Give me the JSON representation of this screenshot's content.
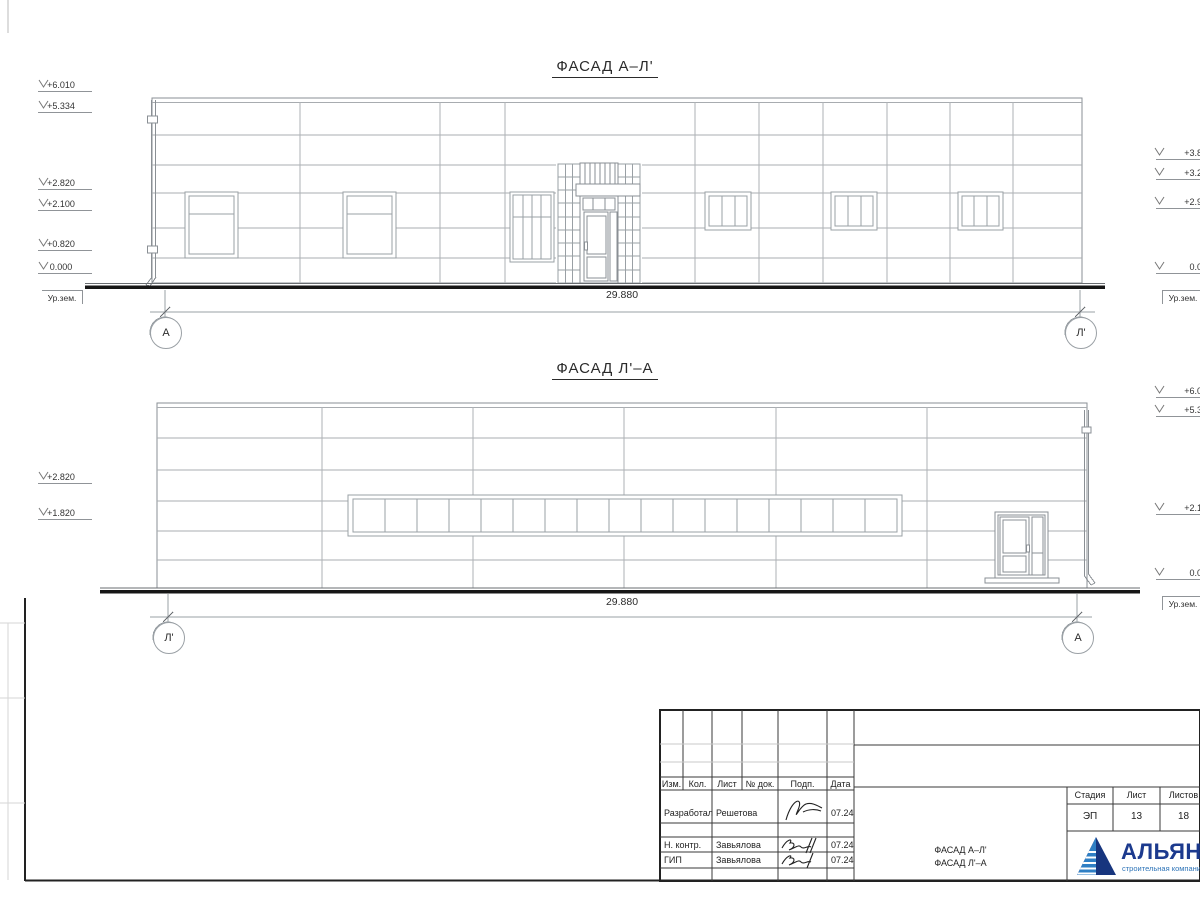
{
  "sheet": {
    "facade1": {
      "title": "ФАСАД А–Л'",
      "dimension": "29.880",
      "axis_left": "А",
      "axis_right": "Л'",
      "marks_left": [
        "+6.010",
        "+5.334",
        "+2.820",
        "+2.100",
        "+0.820",
        "0.000"
      ],
      "ground_left": "Ур.зем.",
      "marks_right": [
        "+3.820",
        "+3.220",
        "+2.920",
        "0.000"
      ],
      "ground_right": "Ур.зем."
    },
    "facade2": {
      "title": "ФАСАД Л'–А",
      "dimension": "29.880",
      "axis_left": "Л'",
      "axis_right": "А",
      "marks_left": [
        "+2.820",
        "+1.820"
      ],
      "marks_right": [
        "+6.010",
        "+5.334",
        "+2.100",
        "0.000"
      ],
      "ground_right": "Ур.зем."
    },
    "titleblock": {
      "headers": [
        "Изм.",
        "Кол.",
        "Лист",
        "№ док.",
        "Подп.",
        "Дата"
      ],
      "rows": [
        {
          "role": "Разработал",
          "name": "Решетова",
          "date": "07.24"
        },
        {
          "role": "Н. контр.",
          "name": "Завьялова",
          "date": "07.24"
        },
        {
          "role": "ГИП",
          "name": "Завьялова",
          "date": "07.24"
        }
      ],
      "doc_name_line1": "ФАСАД А–Л'",
      "doc_name_line2": "ФАСАД Л'–А",
      "stage_label": "Стадия",
      "sheet_label": "Лист",
      "sheets_label": "Листов",
      "stage_value": "ЭП",
      "sheet_value": "13",
      "sheets_value": "18",
      "logo_text": "АЛЬЯНС",
      "logo_subtitle": "строительная компания",
      "logo_color": "#1c3a8e",
      "logo_stripe_color": "#3f9fd8"
    }
  }
}
